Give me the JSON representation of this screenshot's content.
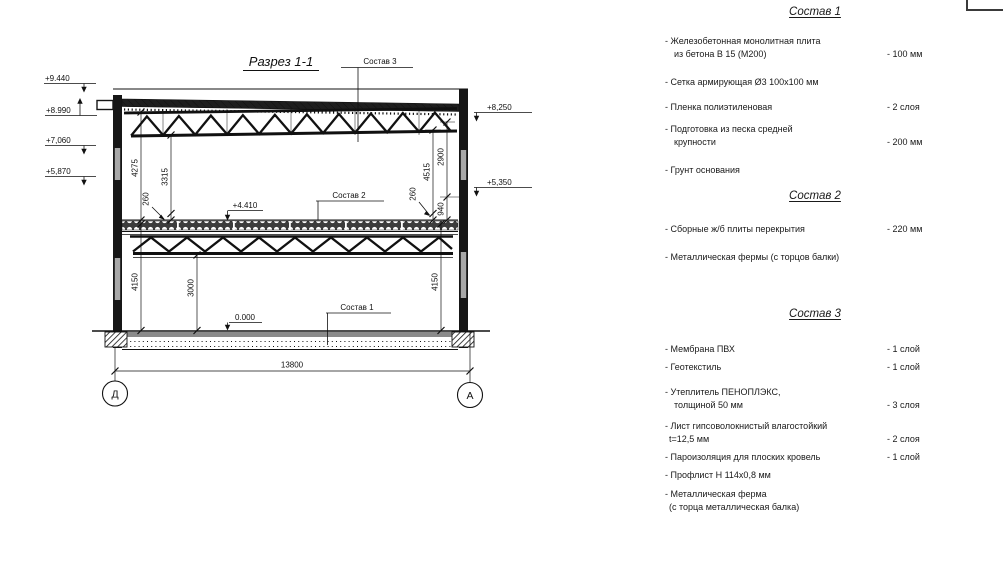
{
  "drawing": {
    "title": "Разрез 1-1",
    "callout_1": "Состав 1",
    "callout_2": "Состав 2",
    "callout_3": "Состав 3",
    "levels": {
      "l9440": "+9.440",
      "l8990": "+8.990",
      "l7060": "+7,060",
      "l5870": "+5,870",
      "r8250": "+8,250",
      "r5350": "+5,350",
      "m4410": "+4.410",
      "zero": "0.000"
    },
    "dims": {
      "a4275": "4275",
      "a3315": "3315",
      "a260l": "260",
      "a4515": "4515",
      "a2900": "2900",
      "a260r": "260",
      "a940": "940",
      "b4150l": "4150",
      "b3000": "3000",
      "b4150r": "4150",
      "total": "13800"
    },
    "axes": {
      "left": "Д",
      "right": "А"
    }
  },
  "panel": {
    "section1": {
      "title": "Состав 1",
      "items": [
        {
          "text": "- Железобетонная  монолитная плита",
          "text2": "из бетона В 15 (М200)",
          "value": "- 100 мм"
        },
        {
          "text": "- Сетка армирующая Ø3 100х100 мм"
        },
        {
          "text": "- Пленка полиэтиленовая",
          "value": "- 2 слоя"
        },
        {
          "text": "- Подготовка из песка средней",
          "text2": "крупности",
          "value": "- 200 мм"
        },
        {
          "text": "- Грунт основания"
        }
      ]
    },
    "section2": {
      "title": "Состав 2",
      "items": [
        {
          "text": "- Сборные ж/б плиты перекрытия",
          "value": "- 220 мм"
        },
        {
          "text": "- Металлическая фермы (с торцов балки)"
        }
      ]
    },
    "section3": {
      "title": "Состав 3",
      "items": [
        {
          "text": "- Мембрана ПВХ",
          "value": "- 1 слой"
        },
        {
          "text": "- Геотекстиль",
          "value": "- 1 слой"
        },
        {
          "text": "- Утеплитель ПЕНОПЛЭКС,",
          "text2": "толщиной 50 мм",
          "value": "- 3 слоя"
        },
        {
          "text": "- Лист гипсоволокнистый влагостойкий",
          "text2": "t=12,5 мм",
          "value": "- 2 слоя"
        },
        {
          "text": "- Пароизоляция для плоских кровель",
          "value": "- 1 слой"
        },
        {
          "text": "- Профлист Н 114х0,8 мм"
        },
        {
          "text": "- Металлическая ферма",
          "text2": "(с торца металлическая балка)"
        }
      ]
    }
  }
}
